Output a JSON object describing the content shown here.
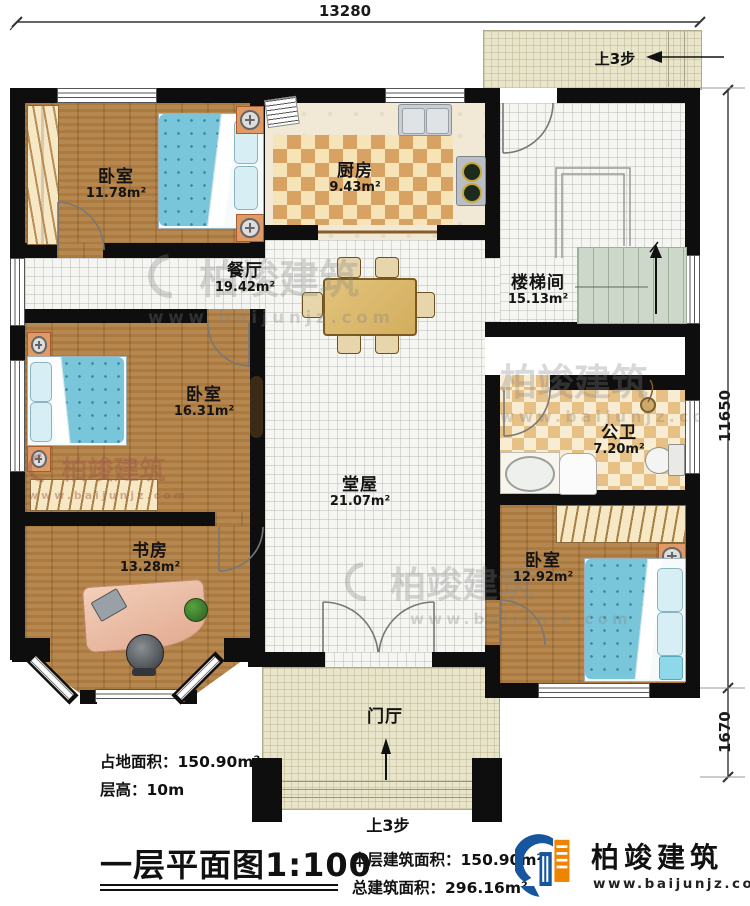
{
  "plan": {
    "dimensions": {
      "top": "13280",
      "right_upper": "11650",
      "right_lower": "1670"
    },
    "steps_note_top": "上3步",
    "steps_note_bottom": "上3步",
    "rooms": [
      {
        "id": "bedroom-1",
        "name": "卧室",
        "area": "11.78m²"
      },
      {
        "id": "kitchen",
        "name": "厨房",
        "area": "9.43m²"
      },
      {
        "id": "dining",
        "name": "餐厅",
        "area": "19.42m²"
      },
      {
        "id": "stairwell",
        "name": "楼梯间",
        "area": "15.13m²"
      },
      {
        "id": "bedroom-2",
        "name": "卧室",
        "area": "16.31m²"
      },
      {
        "id": "bathroom",
        "name": "公卫",
        "area": "7.20m²"
      },
      {
        "id": "hall",
        "name": "堂屋",
        "area": "21.07m²"
      },
      {
        "id": "study",
        "name": "书房",
        "area": "13.28m²"
      },
      {
        "id": "bedroom-3",
        "name": "卧室",
        "area": "12.92m²"
      },
      {
        "id": "foyer",
        "name": "门厅",
        "area": ""
      }
    ]
  },
  "info": {
    "land_area": "占地面积：150.90m²",
    "floor_height": "层高：10m"
  },
  "title_block": {
    "title": "一层平面图",
    "scale": "1:100",
    "floor_area": "本层建筑面积：150.90m²",
    "total_area": "总建筑面积：296.16m²"
  },
  "brand": {
    "name": "柏竣建筑",
    "url": "www.baijunjz.com"
  },
  "watermark": {
    "name": "柏竣建筑",
    "url": "www.baijunjz.com"
  },
  "colors": {
    "wall": "#111111",
    "wood": "#b07f44",
    "bed_blue": "#79c6da",
    "checker_tan": "#d8a263",
    "logo_blue": "#15569e",
    "logo_orange": "#f08300"
  }
}
